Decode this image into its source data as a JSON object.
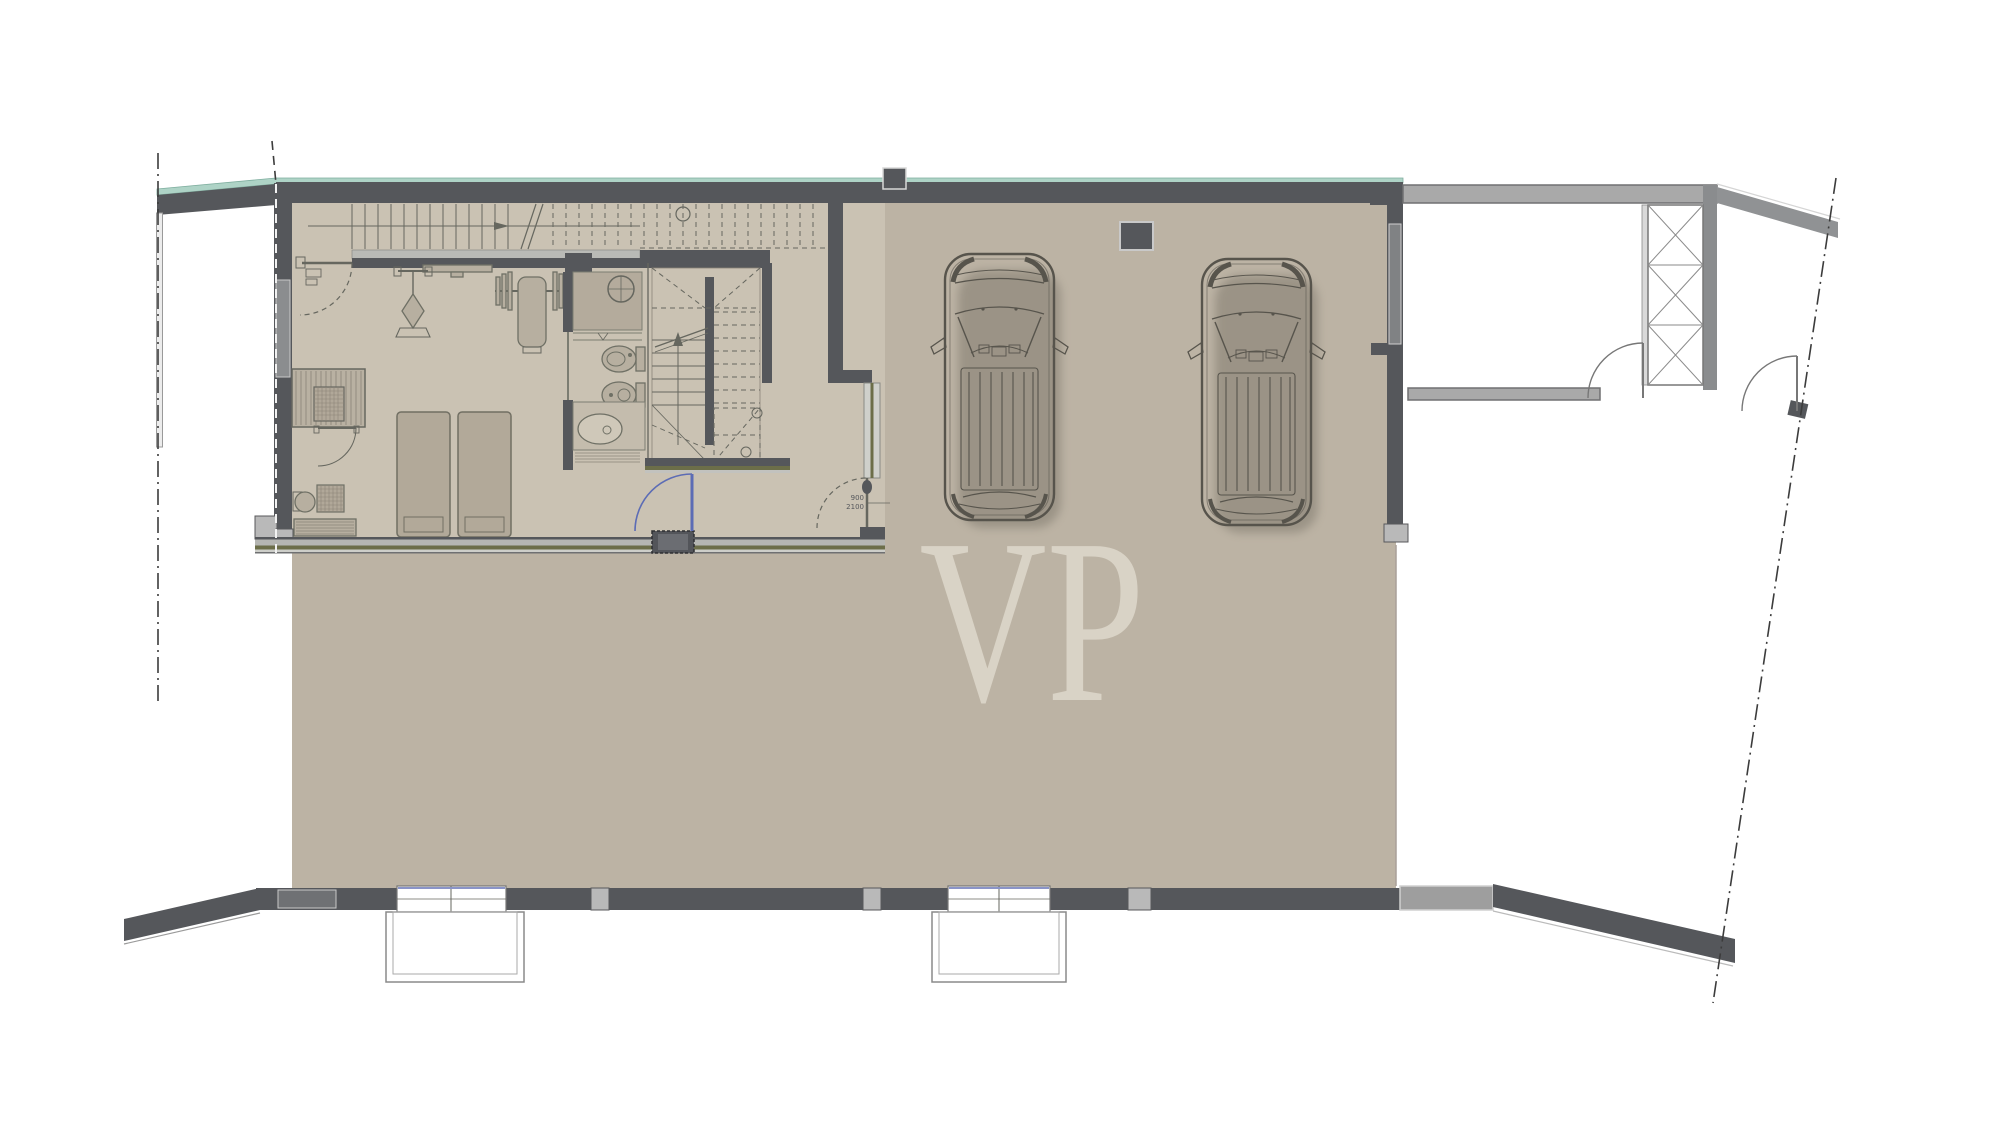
{
  "watermark": {
    "text": "VP"
  },
  "annotations": {
    "hall_door_width": "900",
    "hall_door_height": "2100"
  },
  "colors": {
    "background": "#ffffff",
    "floor_garage": "#bcb3a4",
    "floor_rooms": "#cac2b3",
    "wall_dark": "#55575b",
    "wall_light": "#a9a9a9",
    "glass_teal": "#aed3c6",
    "partition_olive": "#6c6e49",
    "door_blue": "#5c6cb5",
    "line_dark": "#66675f",
    "window_blue": "#8a94c8",
    "watermark": "#dcd6c9"
  },
  "symbols": [
    "top-staircase",
    "central-staircase",
    "gym-pulldown-machine",
    "gym-bench-press",
    "sauna",
    "utility-room",
    "loungers",
    "shower",
    "toilet",
    "bidet",
    "vanity-sink",
    "garage-car",
    "garage-car",
    "wall-vent",
    "wall-niche",
    "light-well-window",
    "light-well-window",
    "shaft-ladder",
    "door-swing",
    "property-line",
    "section-line"
  ]
}
